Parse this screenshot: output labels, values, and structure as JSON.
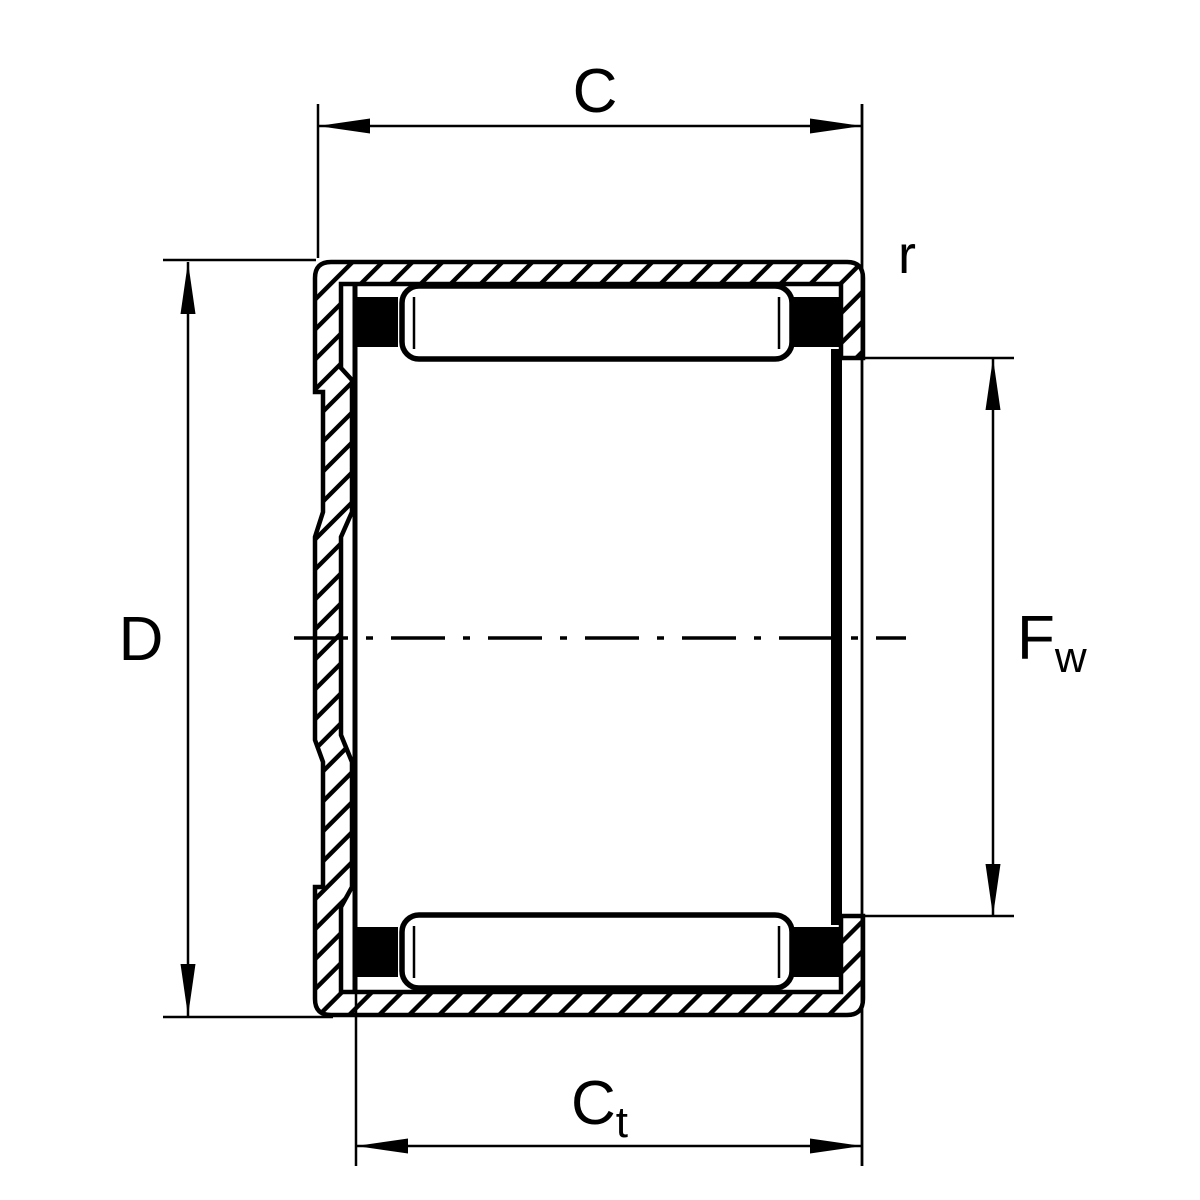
{
  "diagram": {
    "drawing_type": "bearing-cross-section",
    "labels": {
      "outer_width": "C",
      "outer_diameter": "D",
      "corner_radius": "r",
      "inner_width_main": "C",
      "inner_width_sub": "t",
      "bore_main": "F",
      "bore_sub": "w"
    },
    "colors": {
      "line": "#000000",
      "background": "#ffffff"
    }
  }
}
